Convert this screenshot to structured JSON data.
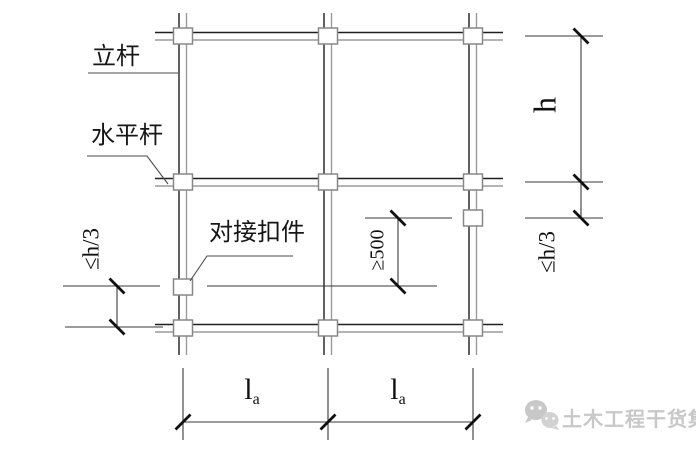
{
  "diagram": {
    "type": "scaffold-butt-joint-stagger-detail",
    "part_labels": {
      "vertical_pole": "立杆",
      "horizontal_pole": "水平杆",
      "butt_coupler": "对接扣件"
    },
    "dimensions": {
      "story_height": "h",
      "coupler_offset_right": "≤h/3",
      "coupler_offset_left": "≤h/3",
      "coupler_stagger": "≥500",
      "spans": [
        {
          "main": "l",
          "sub": "a"
        },
        {
          "main": "l",
          "sub": "a"
        }
      ]
    },
    "watermark": {
      "logo": "wechat-bubbles-icon",
      "text": "土木工程干货集"
    },
    "colors": {
      "background": "#ffffff",
      "pole_line_dark": "#1f1f1f",
      "pole_line_gray": "#9b9b9b",
      "coupler_stroke": "#878787",
      "dimension_line": "#3a3a3a",
      "tick": "#101010",
      "watermark_gray": "#c8c8c8"
    }
  }
}
